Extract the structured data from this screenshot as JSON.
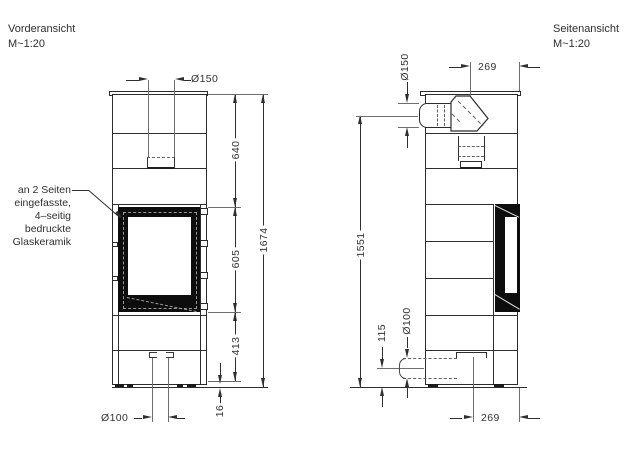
{
  "front_view": {
    "title": "Vorderansicht",
    "scale": "M~1:20",
    "annotation": {
      "l1": "an 2 Seiten",
      "l2": "eingefasste,",
      "l3": "4–seitig",
      "l4": "bedruckte",
      "l5": "Glaskeramik"
    },
    "dimensions": {
      "flue_diameter": "Ø150",
      "upper_section_height": "640",
      "overall_height": "1674",
      "glass_section_height": "605",
      "base_section_height": "413",
      "foot_height": "16",
      "air_inlet_diameter": "Ø100"
    }
  },
  "side_view": {
    "title": "Seitenansicht",
    "scale": "M~1:20",
    "dimensions": {
      "flue_diameter": "Ø150",
      "flue_axis_to_front": "269",
      "flue_axis_height": "1551",
      "air_inlet_axis_height": "115",
      "air_inlet_diameter": "Ø100",
      "air_inlet_axis_to_front": "269"
    }
  },
  "colors": {
    "line": "#2b2b2b",
    "dark_fill": "#0d0d0d",
    "background": "#ffffff"
  }
}
